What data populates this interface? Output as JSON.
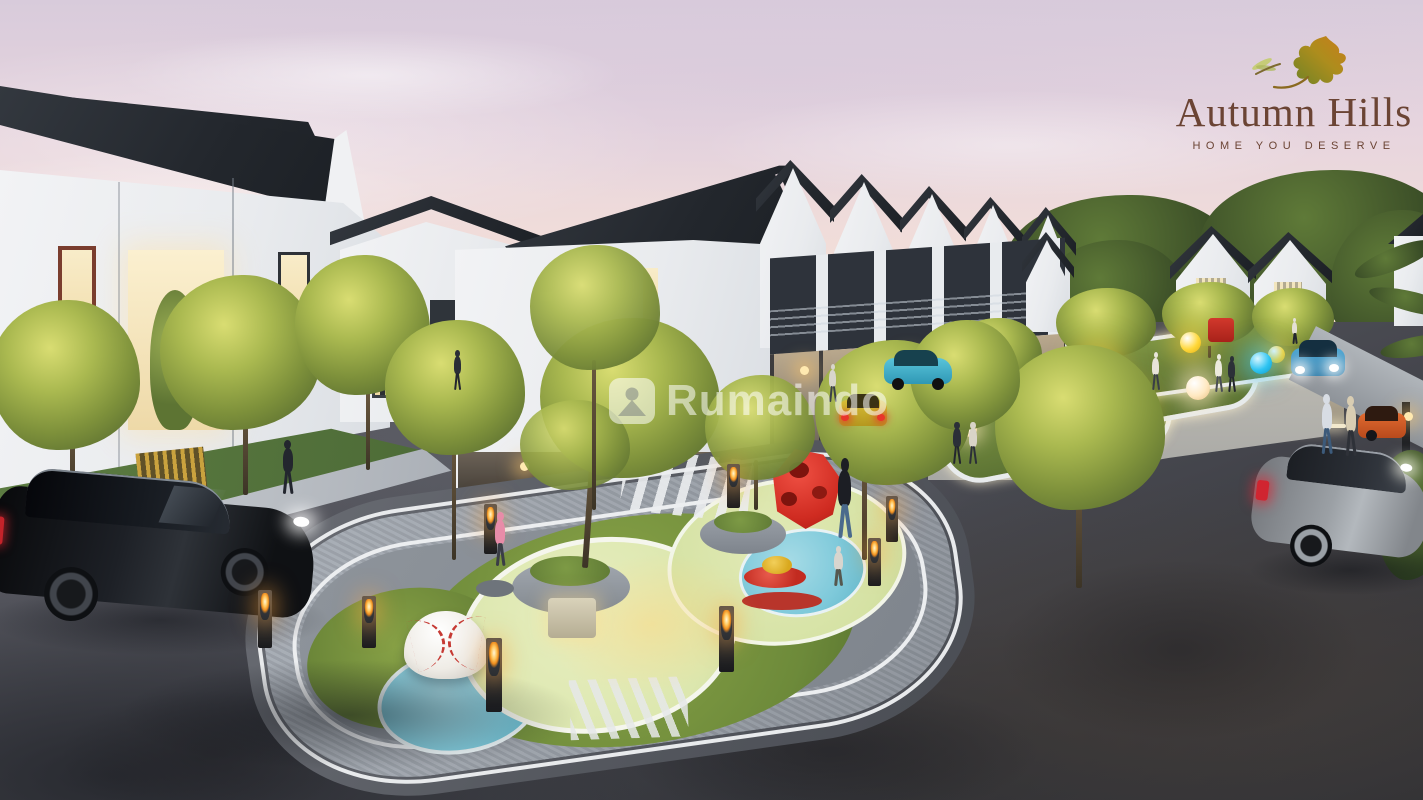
{
  "meta": {
    "type": "architectural-render",
    "view": "aerial dusk view of residential cluster with central playground"
  },
  "logo": {
    "title": "Autumn Hills",
    "tagline": "HOME YOU DESERVE",
    "text_color": "#6b4434",
    "icon": "oak-leaf-with-dragonfly",
    "leaf_colors": [
      "#76882c",
      "#b5901f",
      "#c97d1a"
    ]
  },
  "watermark": {
    "text": "Rumaindo",
    "icon": "house-logo",
    "color": "rgba(255,255,255,0.55)"
  },
  "scene": {
    "sky": {
      "top": "#d8cbdb",
      "mid": "#f1ddd9",
      "horizon": "#f8e6d2"
    },
    "road": {
      "light": "#63646c",
      "dark": "#303136"
    },
    "houses": {
      "roof": "#23272d",
      "wall": "#edeff1",
      "warm_window": "#f6e4bc"
    },
    "island": {
      "curb": "#5e6167",
      "brick_ring": "#9aa0a8",
      "lawn": "#7e913b",
      "pad": "#dfe8b2",
      "splash": "#7ec9da"
    },
    "accents": {
      "lamp_flame": "#ffc85e",
      "orb_yellow": "#ffd83b",
      "orb_cyan": "#2fc4f2",
      "orb_white": "#ffeccb",
      "play_red": "#d03028"
    },
    "play_equipment": [
      "baseball-half-dome",
      "red-polyhedron-climber",
      "red-spinner-top",
      "circular-tree-planters"
    ],
    "cars": [
      {
        "name": "black-suv-foreground"
      },
      {
        "name": "gray-hatchback-right"
      },
      {
        "name": "teal-carport-car"
      },
      {
        "name": "yellow-street-car"
      },
      {
        "name": "blue-driving-car"
      },
      {
        "name": "orange-parked-car"
      },
      {
        "name": "red-mini-truck"
      }
    ],
    "people_count": 14
  }
}
